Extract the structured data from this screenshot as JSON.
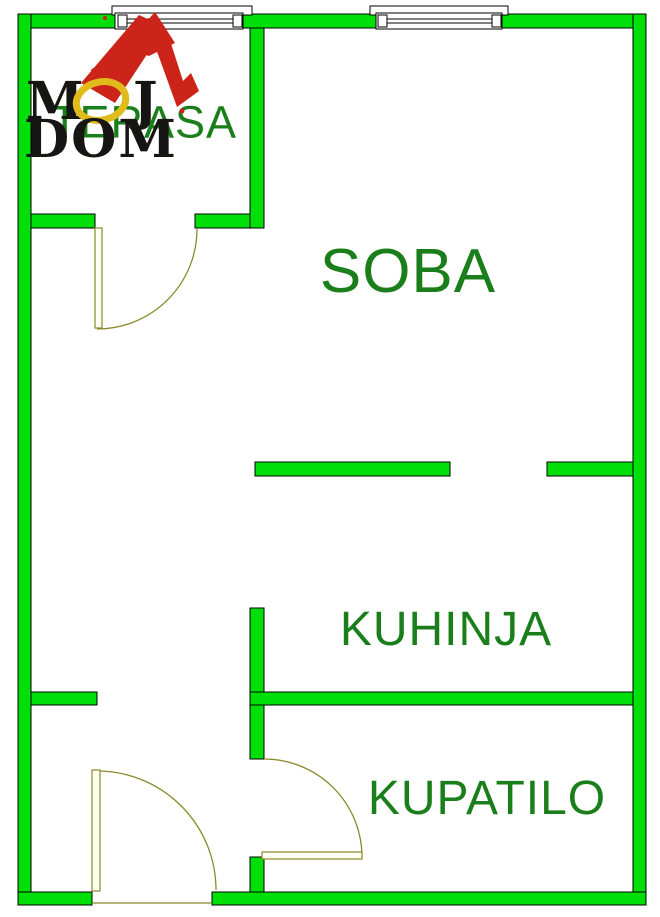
{
  "rooms": {
    "terasa": {
      "label": "TERASA"
    },
    "soba": {
      "label": "SOBA"
    },
    "kuhinja": {
      "label": "KUHINJA"
    },
    "kupatilo": {
      "label": "KUPATILO"
    }
  },
  "logo": {
    "m": "M",
    "o": "O",
    "j": "J",
    "dom": "DOM"
  },
  "colors": {
    "wall_fill": "#00df0a",
    "wall_outline": "#000000",
    "label_text": "#1a7f1a",
    "door_line": "#8a8a2a",
    "logo_black": "#171513",
    "logo_yellow": "#e0bb1c",
    "logo_red": "#cc2418",
    "background": "#ffffff"
  }
}
